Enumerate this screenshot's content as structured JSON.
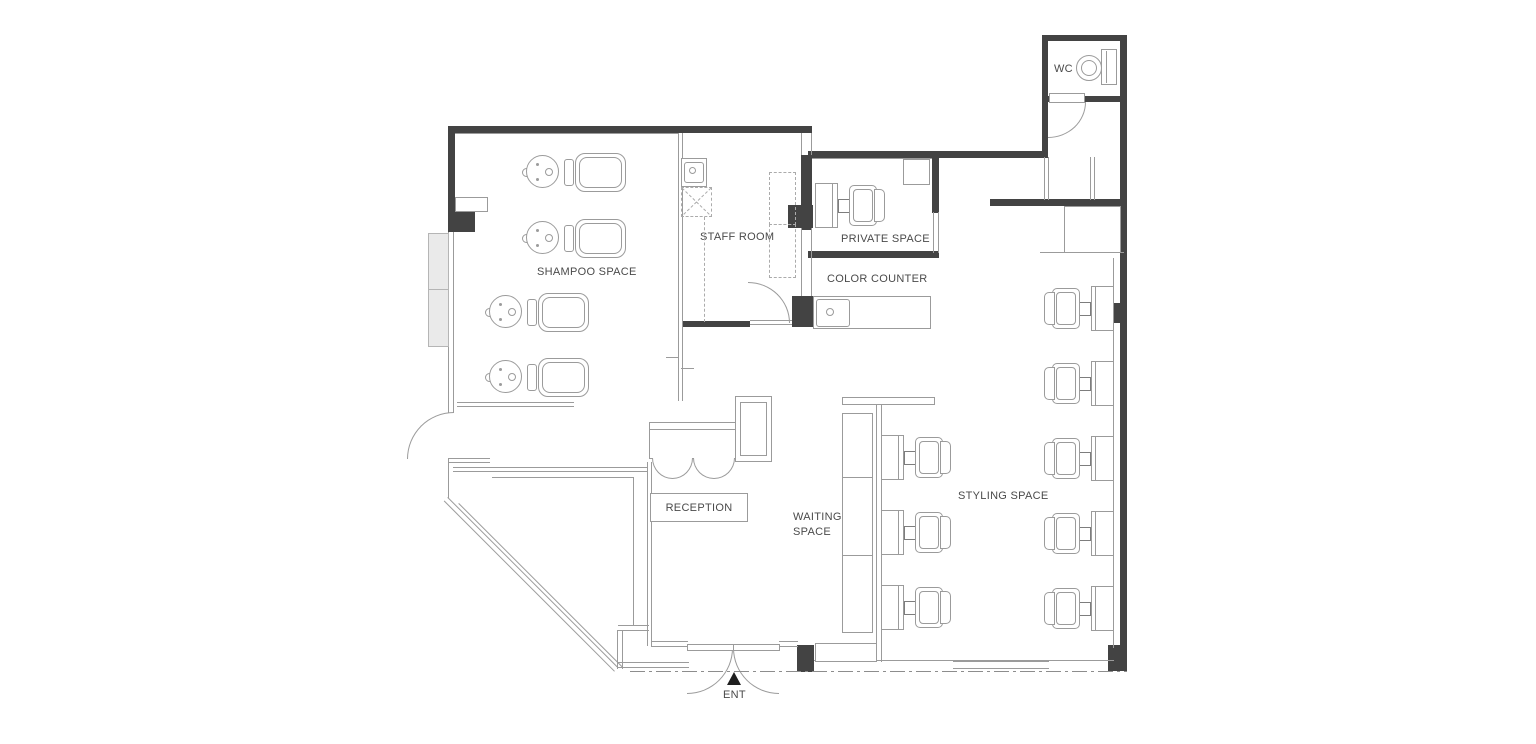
{
  "labels": {
    "shampoo_space": "SHAMPOO SPACE",
    "staff_room": "STAFF ROOM",
    "private_space": "PRIVATE SPACE",
    "color_counter": "COLOR COUNTER",
    "wc": "WC",
    "locker": "LOCKER",
    "reception": "RECEPTION",
    "waiting_line1": "WAITING",
    "waiting_line2": "SPACE",
    "styling_space": "STYLING SPACE",
    "entrance": "ENT"
  },
  "fixtures": {
    "shampoo_units": 4,
    "styling_stations_right_wall": 5,
    "styling_stations_island": 3,
    "styling_stations_private": 1,
    "waiting_bench_seats": 3,
    "toilets": 1
  },
  "colors": {
    "wall": "#434343",
    "line": "#9b9b9b",
    "dash": "#ababab",
    "text": "#4a4a4a",
    "light_fill": "#eaeaea"
  }
}
